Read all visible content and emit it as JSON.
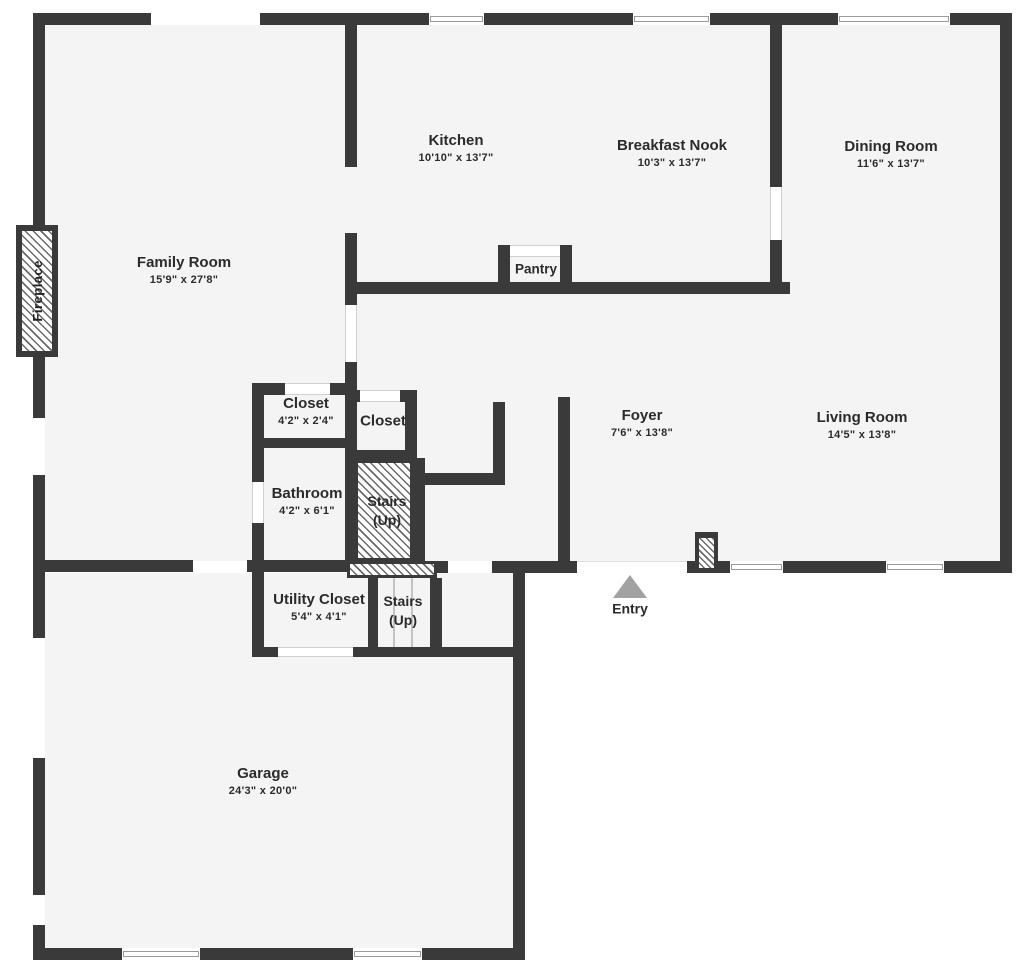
{
  "plan_title": "First floor plan",
  "colors": {
    "wall": "#3a3a3a",
    "floor": "#f4f4f4",
    "text": "#2b2b2b",
    "entry_arrow": "#a2a2a2",
    "window_frame": "#9a9a9a"
  },
  "rooms": [
    {
      "id": "family-room",
      "name": "Family Room",
      "dims": "15'9\" x 27'8\""
    },
    {
      "id": "kitchen",
      "name": "Kitchen",
      "dims": "10'10\" x 13'7\""
    },
    {
      "id": "breakfast-nook",
      "name": "Breakfast Nook",
      "dims": "10'3\" x 13'7\""
    },
    {
      "id": "dining-room",
      "name": "Dining Room",
      "dims": "11'6\" x 13'7\""
    },
    {
      "id": "pantry",
      "name": "Pantry",
      "dims": ""
    },
    {
      "id": "closet-main",
      "name": "Closet",
      "dims": "4'2\" x 2'4\""
    },
    {
      "id": "closet-hall",
      "name": "Closet",
      "dims": ""
    },
    {
      "id": "bathroom",
      "name": "Bathroom",
      "dims": "4'2\" x 6'1\""
    },
    {
      "id": "stairs-upper",
      "name": "Stairs",
      "dims": "(Up)"
    },
    {
      "id": "foyer",
      "name": "Foyer",
      "dims": "7'6\" x 13'8\""
    },
    {
      "id": "living-room",
      "name": "Living Room",
      "dims": "14'5\" x 13'8\""
    },
    {
      "id": "utility-closet",
      "name": "Utility Closet",
      "dims": "5'4\" x 4'1\""
    },
    {
      "id": "stairs-lower",
      "name": "Stairs",
      "dims": "(Up)"
    },
    {
      "id": "garage",
      "name": "Garage",
      "dims": "24'3\" x 20'0\""
    }
  ],
  "markers": {
    "entry": "Entry",
    "fireplace": "Fireplace"
  }
}
